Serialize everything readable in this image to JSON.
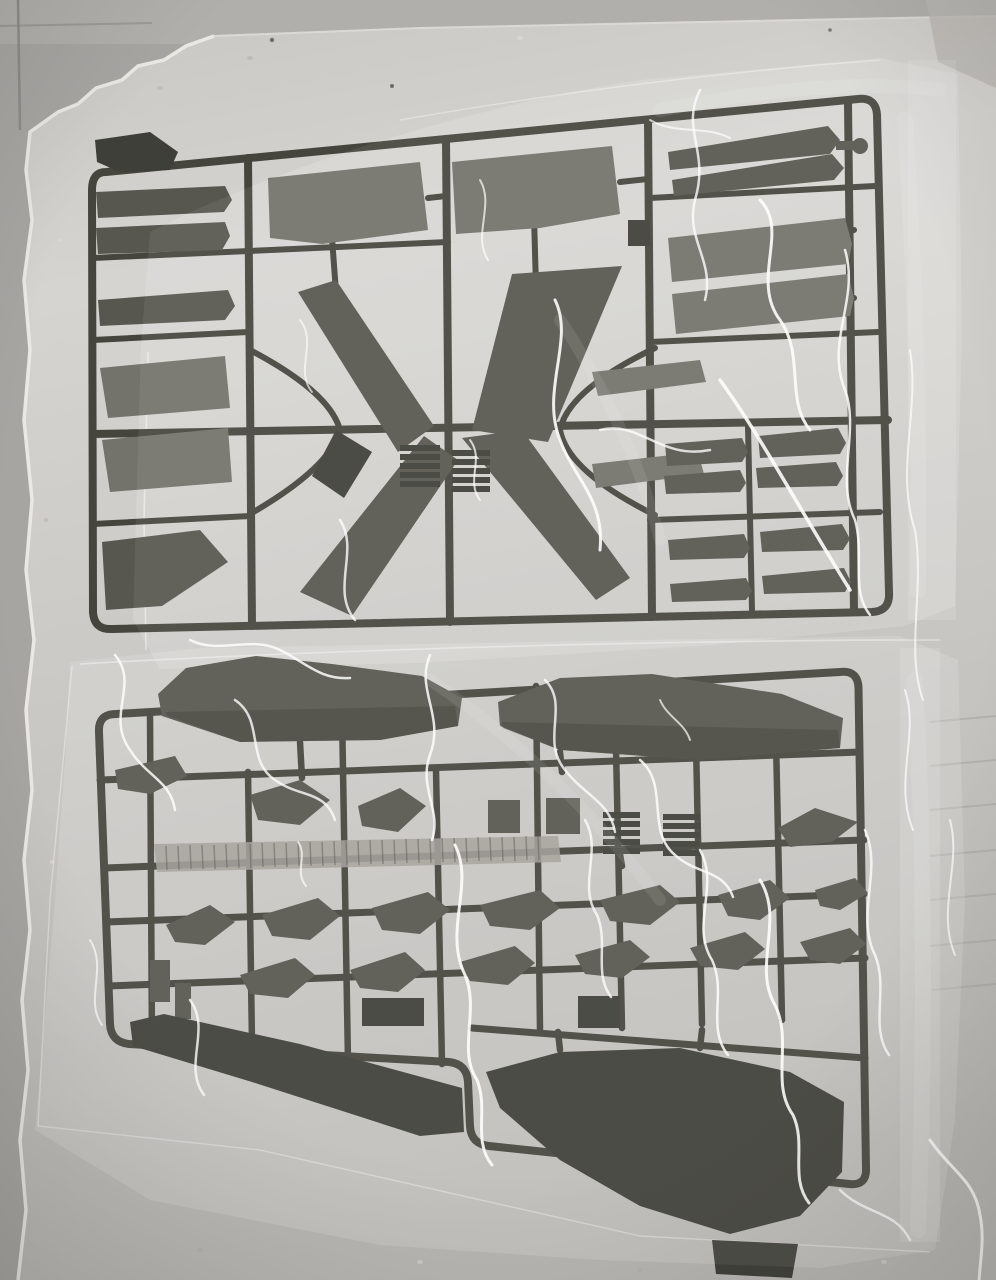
{
  "photo": {
    "subject": "Unassembled plastic model kit: two dark grey sprues of aircraft parts sealed in clear plastic bags, lying on a white polystyrene foam tray",
    "elements": {
      "foam_tray": "white foam tray with torn left and top edges",
      "top_bag": "clear plastic bag with wrinkle glare over upper sprue",
      "top_sprue": "sprue with wing and tail panels, long tapered blades crossed in an X, stacked trapezoid panels and rows of narrow strips",
      "bottom_bag": "clear plastic bag with folded right edge over lower sprue",
      "bottom_sprue": "sprue with two long fuselage halves, ribbed hinge strip, rows of small wedge parts, a long dark intake blade and a large lower fuselage piece"
    }
  },
  "colors": {
    "backdrop": "#a7a5a2",
    "backdrop_band": "#b1afab",
    "foam_light": "#d6d4d0",
    "foam_mid": "#c9c7c3",
    "foam_dark": "#b9b7b3",
    "foam_edge": "#eceae6",
    "sprue_runner": "#45453e",
    "part_dark": "#3f3f39",
    "part_mid": "#57574f",
    "part_panel": "#73736b",
    "ribbed_strip": "#a29f99",
    "bag_sheen": "#ffffff",
    "glare": "#fdfdfc"
  }
}
